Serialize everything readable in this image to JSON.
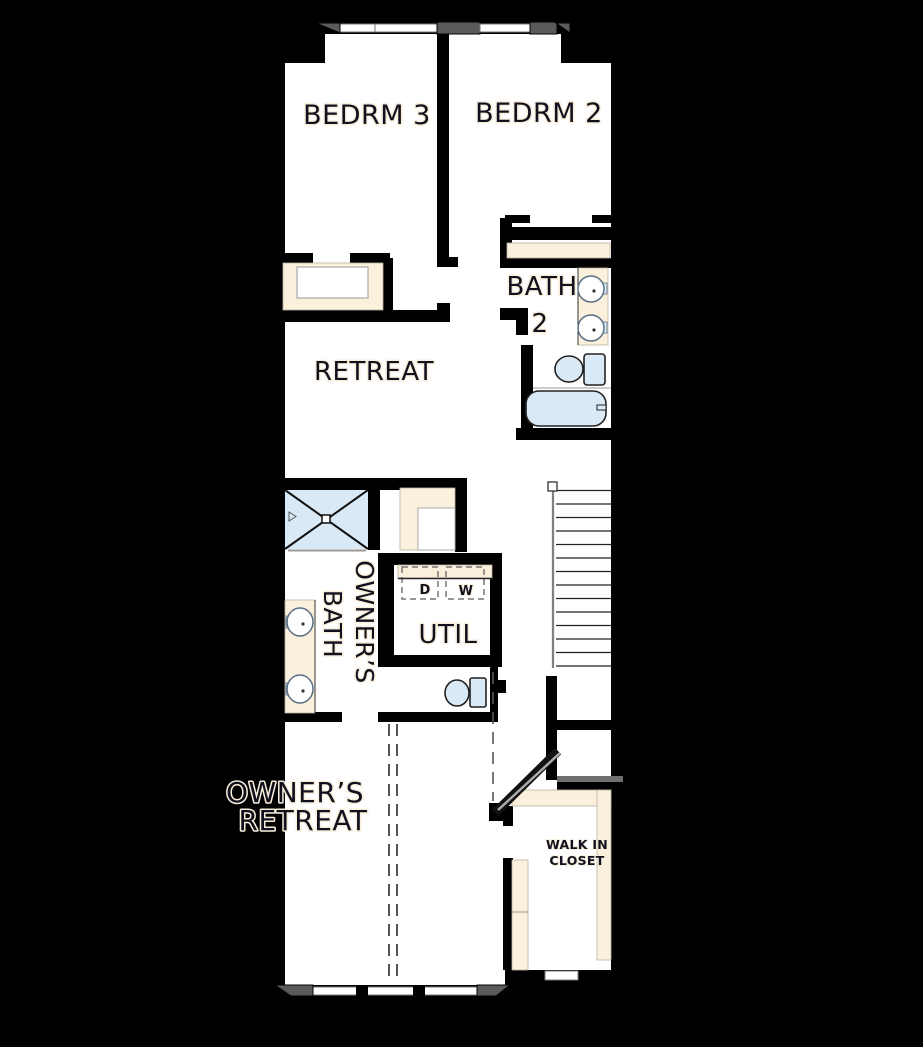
{
  "colors": {
    "background": "#000000",
    "floor": "#ffffff",
    "wall": "#000000",
    "casework": "#faf0dc",
    "fixture": "#d9eaf6",
    "window_frame": "#5a5a5a",
    "text": "#10101e",
    "halo": "#f8eeda",
    "dash": "#555555"
  },
  "labels": {
    "bedrm3": "BEDRM 3",
    "bedrm2": "BEDRM 2",
    "bath2_line1": "BATH",
    "bath2_line2": "2",
    "retreat": "RETREAT",
    "owners_bath_line1": "OWNER’S",
    "owners_bath_line2": "BATH",
    "util": "UTIL",
    "dryer": "D",
    "washer": "W",
    "owners_retreat_line1": "OWNER’S",
    "owners_retreat_line2": "RETREAT",
    "walk_in_closet_line1": "WALK IN",
    "walk_in_closet_line2": "CLOSET"
  }
}
